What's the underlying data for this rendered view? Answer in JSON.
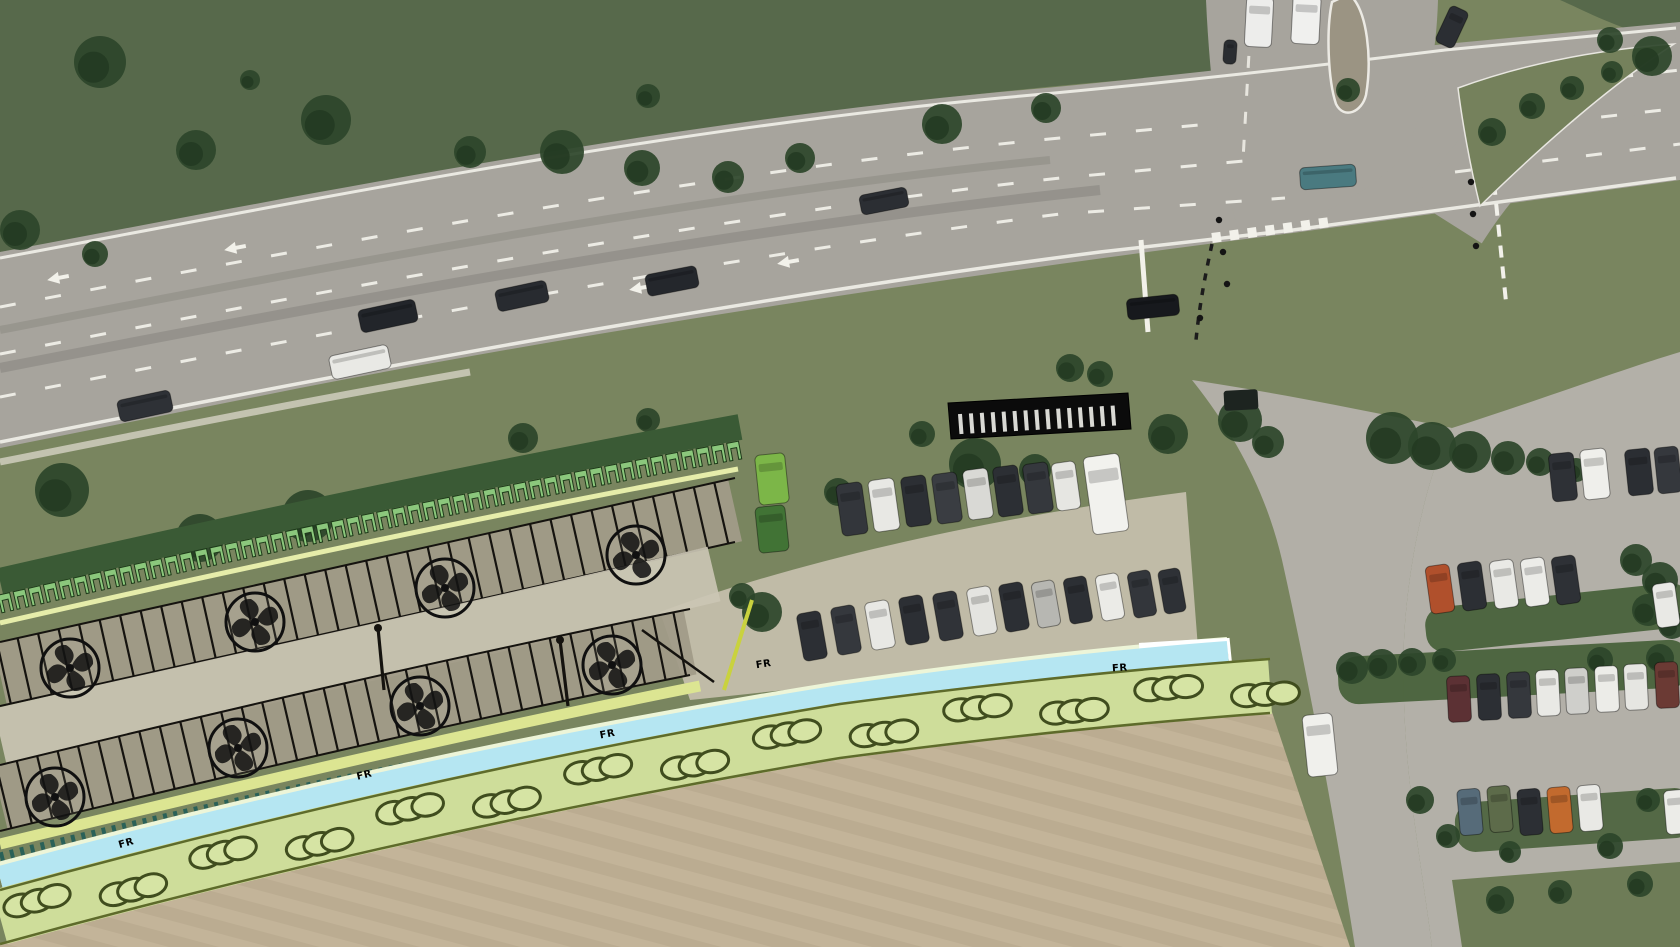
{
  "scene": {
    "type": "aerial-photo-with-site-plan-overlay",
    "width": 1680,
    "height": 947
  },
  "colors": {
    "grass_base": "#79855f",
    "hill_grass": "#57694b",
    "hill_tree_dark": "#2c452a",
    "hill_tree_core": "#223821",
    "field_tan": "#c3b499",
    "road_gray": "#a7a49d",
    "lot_gray": "#b3b0a8",
    "apron_gray": "#c9c3b2",
    "sidewalk": "#d6d2c4",
    "marking_white": "#f2f1ea",
    "stall_fill": "#a19b88",
    "aisle_fill": "#cbc5b4",
    "pi_backing_green": "#3a5a35",
    "pi_symbol_green": "#8bc77c",
    "pi_symbol_outline": "#1d3a19",
    "yellow_line": "#e6edaa",
    "yellow_strip": "#dce592",
    "teal_hatch": "#2a6158",
    "cycle_path_blue": "#b5e6f2",
    "cycle_path_edge": "#edf5d8",
    "shrub_band": "#cedd9a",
    "shrub_fill": "#d6e4a4",
    "shrub_outline": "#404d1e",
    "plan_linework_black": "#15130f",
    "label_blue": "#1c6fd4",
    "hatch_bar_black": "#0b0b0b",
    "hatch_tick_white": "#d9d9d4",
    "hedge_green": "#49623b",
    "island_gravel": "#9b9483",
    "end_line_yellow": "#c9d23e"
  },
  "path_labels": {
    "text": "FR",
    "positions": [
      [
        127,
        846,
        -16
      ],
      [
        365,
        778,
        -14
      ],
      [
        608,
        737,
        -11
      ],
      [
        764,
        667,
        -9
      ],
      [
        1120,
        671,
        -4
      ]
    ]
  },
  "plan_overlay": {
    "pi_symbol_spacing": 15.5,
    "stall_spacing": 21,
    "stall_half_length_upper": 31,
    "stall_half_length_lower": 32,
    "shrub_chain_spacing": 96,
    "tree_positions": [
      [
        70,
        668
      ],
      [
        255,
        622
      ],
      [
        445,
        588
      ],
      [
        636,
        555
      ],
      [
        55,
        797
      ],
      [
        238,
        748
      ],
      [
        420,
        706
      ],
      [
        612,
        665
      ]
    ],
    "lamp_positions": [
      [
        560,
        640,
        568,
        706
      ],
      [
        378,
        628,
        384,
        690
      ]
    ],
    "hatch_bar_ticks": 15
  },
  "vehicles": {
    "road": [
      [
        145,
        406,
        54,
        22,
        -12,
        "#2e3136"
      ],
      [
        388,
        316,
        58,
        23,
        -12,
        "#22252a"
      ],
      [
        360,
        362,
        60,
        24,
        -12,
        "#e9e9e5"
      ],
      [
        522,
        296,
        52,
        22,
        -12,
        "#282b30"
      ],
      [
        672,
        281,
        52,
        22,
        -11,
        "#24272c"
      ],
      [
        884,
        201,
        48,
        20,
        -11,
        "#2b2e33"
      ],
      [
        1153,
        307,
        52,
        21,
        -6,
        "#17191d"
      ],
      [
        1328,
        177,
        56,
        22,
        -4,
        "#4a7a80"
      ],
      [
        1230,
        52,
        13,
        24,
        4,
        "#2a2d31"
      ],
      [
        1259,
        22,
        27,
        50,
        3,
        "#ededeb"
      ],
      [
        1306,
        20,
        28,
        48,
        3,
        "#f0f0ee"
      ],
      [
        1452,
        27,
        20,
        40,
        25,
        "#2b2e33"
      ]
    ],
    "middle_row_upper": [
      [
        852,
        509,
        26,
        52,
        -8,
        "#33363b"
      ],
      [
        884,
        505,
        26,
        52,
        -8,
        "#e8e8e4"
      ],
      [
        916,
        501,
        25,
        50,
        -8,
        "#2c2f34"
      ],
      [
        947,
        498,
        25,
        50,
        -8,
        "#3a3d42"
      ],
      [
        978,
        494,
        25,
        50,
        -8,
        "#d9d9d5"
      ],
      [
        1008,
        491,
        25,
        50,
        -8,
        "#2c2f34"
      ],
      [
        1038,
        488,
        25,
        50,
        -8,
        "#35383d"
      ],
      [
        1066,
        486,
        24,
        48,
        -8,
        "#e6e6e2"
      ]
    ],
    "middle_row_lower": [
      [
        812,
        636,
        24,
        48,
        -10,
        "#2c2f34"
      ],
      [
        846,
        630,
        24,
        48,
        -10,
        "#35383d"
      ],
      [
        880,
        625,
        24,
        48,
        -10,
        "#e8e8e4"
      ],
      [
        914,
        620,
        24,
        48,
        -10,
        "#2c2f34"
      ],
      [
        948,
        616,
        24,
        48,
        -10,
        "#303338"
      ],
      [
        982,
        611,
        24,
        48,
        -10,
        "#e4e4e0"
      ],
      [
        1014,
        607,
        24,
        48,
        -10,
        "#2c2f34"
      ],
      [
        1046,
        604,
        23,
        46,
        -10,
        "#b7b7b2"
      ],
      [
        1078,
        600,
        23,
        46,
        -10,
        "#2c2f34"
      ],
      [
        1110,
        597,
        23,
        46,
        -10,
        "#ebebe7"
      ],
      [
        1142,
        594,
        23,
        46,
        -10,
        "#33363b"
      ],
      [
        1172,
        591,
        22,
        44,
        -10,
        "#2e3136"
      ]
    ],
    "lot_row_1": [
      [
        1563,
        477,
        25,
        48,
        -6,
        "#2e3136"
      ],
      [
        1595,
        474,
        26,
        50,
        -6,
        "#efefeb"
      ],
      [
        1639,
        472,
        25,
        46,
        -6,
        "#2b2e33"
      ],
      [
        1668,
        470,
        24,
        46,
        -6,
        "#35383d"
      ]
    ],
    "lot_row_2": [
      [
        1440,
        589,
        24,
        48,
        -8,
        "#b0502c"
      ],
      [
        1472,
        586,
        24,
        48,
        -8,
        "#2c2f34"
      ],
      [
        1504,
        584,
        24,
        48,
        -8,
        "#e9e9e5"
      ],
      [
        1535,
        582,
        24,
        48,
        -8,
        "#ecece8"
      ],
      [
        1566,
        580,
        24,
        48,
        -8,
        "#2e3136"
      ],
      [
        1666,
        605,
        23,
        44,
        -8,
        "#e9e9e5"
      ]
    ],
    "lot_row_3": [
      [
        1459,
        699,
        23,
        46,
        -3,
        "#5c3134"
      ],
      [
        1489,
        697,
        23,
        46,
        -3,
        "#2c2f34"
      ],
      [
        1519,
        695,
        23,
        46,
        -3,
        "#35383d"
      ],
      [
        1548,
        693,
        23,
        46,
        -3,
        "#e9e9e5"
      ],
      [
        1577,
        691,
        23,
        46,
        -3,
        "#cfcfcb"
      ],
      [
        1607,
        689,
        23,
        46,
        -3,
        "#ecece8"
      ],
      [
        1636,
        687,
        23,
        46,
        -3,
        "#e6e6e2"
      ],
      [
        1667,
        685,
        23,
        46,
        -3,
        "#6b3a34"
      ]
    ],
    "lot_row_4": [
      [
        1470,
        812,
        23,
        46,
        -5,
        "#566b79"
      ],
      [
        1500,
        809,
        23,
        46,
        -5,
        "#5d6b4a"
      ],
      [
        1530,
        812,
        23,
        46,
        -5,
        "#2c2f34"
      ],
      [
        1560,
        810,
        23,
        46,
        -5,
        "#c26a2e"
      ],
      [
        1590,
        808,
        23,
        46,
        -5,
        "#e9e9e5"
      ],
      [
        1676,
        812,
        22,
        44,
        -5,
        "#ecece8"
      ]
    ],
    "special": {
      "bus": [
        1106,
        494,
        36,
        78,
        -8,
        "#f2f2ee"
      ],
      "access_van": [
        1320,
        745,
        30,
        62,
        -6,
        "#f0f0ec"
      ],
      "green_container_top": [
        772,
        479,
        30,
        50,
        -6,
        "#7cb648"
      ],
      "green_container_bottom": [
        772,
        529,
        30,
        46,
        -6,
        "#417335"
      ]
    }
  },
  "vegetation": {
    "hill": [
      [
        100,
        62,
        26
      ],
      [
        196,
        150,
        20
      ],
      [
        326,
        120,
        25
      ],
      [
        470,
        152,
        16
      ],
      [
        562,
        152,
        22
      ],
      [
        642,
        168,
        18
      ],
      [
        728,
        177,
        16
      ],
      [
        800,
        158,
        15
      ],
      [
        942,
        124,
        20
      ],
      [
        1046,
        108,
        15
      ],
      [
        20,
        230,
        20
      ],
      [
        95,
        254,
        13
      ],
      [
        648,
        96,
        12
      ],
      [
        250,
        80,
        10
      ],
      [
        1652,
        56,
        20
      ],
      [
        1610,
        40,
        13
      ]
    ],
    "verge": [
      [
        62,
        490,
        27
      ],
      [
        200,
        538,
        24
      ],
      [
        308,
        516,
        26
      ],
      [
        523,
        438,
        15
      ],
      [
        648,
        420,
        12
      ],
      [
        975,
        464,
        26
      ],
      [
        1035,
        470,
        16
      ],
      [
        1168,
        434,
        20
      ],
      [
        922,
        434,
        13
      ],
      [
        838,
        492,
        14
      ],
      [
        1240,
        420,
        22
      ],
      [
        1268,
        442,
        16
      ],
      [
        1070,
        368,
        14
      ],
      [
        1100,
        374,
        13
      ],
      [
        762,
        612,
        20
      ],
      [
        742,
        596,
        13
      ]
    ],
    "intersection_islands": [
      [
        1492,
        132,
        14
      ],
      [
        1532,
        106,
        13
      ],
      [
        1572,
        88,
        12
      ],
      [
        1612,
        72,
        11
      ],
      [
        1348,
        90,
        12
      ]
    ],
    "right_lot": [
      [
        1392,
        438,
        26
      ],
      [
        1432,
        446,
        24
      ],
      [
        1470,
        452,
        21
      ],
      [
        1508,
        458,
        17
      ],
      [
        1540,
        462,
        14
      ],
      [
        1576,
        470,
        12
      ],
      [
        1636,
        560,
        16
      ],
      [
        1660,
        580,
        18
      ],
      [
        1648,
        610,
        16
      ],
      [
        1672,
        625,
        14
      ],
      [
        1352,
        668,
        16
      ],
      [
        1382,
        664,
        15
      ],
      [
        1412,
        662,
        14
      ],
      [
        1444,
        660,
        12
      ],
      [
        1600,
        660,
        13
      ],
      [
        1660,
        658,
        14
      ],
      [
        1420,
        800,
        14
      ],
      [
        1448,
        836,
        12
      ],
      [
        1610,
        846,
        13
      ],
      [
        1648,
        800,
        12
      ],
      [
        1510,
        852,
        11
      ],
      [
        1500,
        900,
        14
      ],
      [
        1560,
        892,
        12
      ],
      [
        1640,
        884,
        13
      ]
    ]
  },
  "street_furniture": {
    "signal_dots": [
      [
        1219,
        220
      ],
      [
        1223,
        252
      ],
      [
        1227,
        284
      ],
      [
        1200,
        318
      ],
      [
        1471,
        182
      ],
      [
        1473,
        214
      ],
      [
        1476,
        246
      ]
    ],
    "bench": [
      1224,
      390,
      34,
      20,
      -3
    ]
  }
}
